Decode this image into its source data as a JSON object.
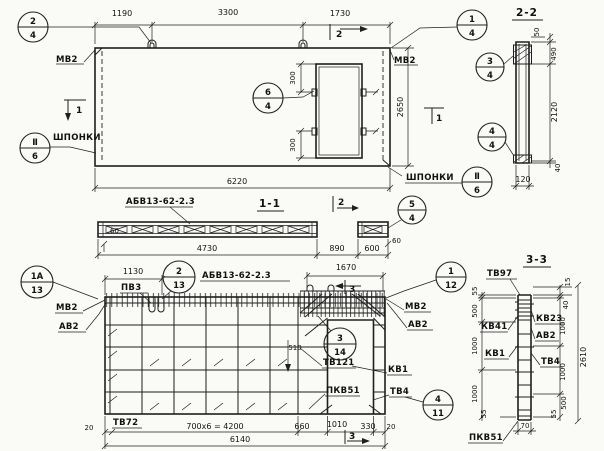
{
  "plan": {
    "dims": {
      "left": "1190",
      "mid": "3300",
      "right": "1730",
      "total": "6220",
      "height": "2650",
      "off_top": "300",
      "off_bot": "300"
    },
    "labels": {
      "mv2_left": "МВ2",
      "mv2_right": "МВ2",
      "shponki_left": "ШПОНКИ",
      "shponki_right": "ШПОНКИ"
    },
    "marks": {
      "s2": "2",
      "s1_left": "1",
      "s1_right": "1"
    }
  },
  "sec11": {
    "title": "1-1",
    "label": "АБВ13-62-2.3",
    "dims": {
      "d60l": "60",
      "d4730": "4730",
      "d890": "890",
      "d600": "600",
      "d60r": "60"
    },
    "mark2": "2"
  },
  "sec22": {
    "title": "2-2",
    "dims": {
      "d50": "50",
      "d490": "490",
      "d2120": "2120",
      "d40": "40",
      "d120": "120"
    }
  },
  "elev": {
    "title": "АБВ13-62-2.3",
    "labels": {
      "pv3": "ПВ3",
      "mv2_left": "МВ2",
      "av2_left": "АВ2",
      "mv2_right": "МВ2",
      "av2_right": "АВ2",
      "tv121": "ТВ121",
      "kv1": "КВ1",
      "pkv51": "ПКВ51",
      "tv4": "ТВ4",
      "tv72": "ТВ72"
    },
    "dims": {
      "d1130": "1130",
      "d1670": "1670",
      "d510": "510",
      "d20l": "20",
      "d4200": "700x6 = 4200",
      "d660": "660",
      "d1010": "1010",
      "d330": "330",
      "d20r": "20",
      "total": "6140"
    },
    "marks": {
      "s3_top": "3",
      "s3_bot": "3"
    }
  },
  "sec33": {
    "title": "3-3",
    "labels": {
      "tv97": "ТВ97",
      "kv41": "КВ41",
      "kv1": "КВ1",
      "kv23": "КВ23",
      "av2": "АВ2",
      "tv4": "ТВ4",
      "pkv51": "ПКВ51"
    },
    "dims_left": {
      "a": "55",
      "b": "500",
      "c": "1000",
      "d": "1000",
      "e": "55"
    },
    "dims_right": {
      "a": "15",
      "b": "40",
      "c": "1000",
      "d": "1000",
      "e": "500",
      "f": "55"
    },
    "dims": {
      "total": "2610",
      "d70": "70"
    }
  },
  "callouts": {
    "c2_4": {
      "num": "2",
      "den": "4"
    },
    "c1_4": {
      "num": "1",
      "den": "4"
    },
    "c3_4": {
      "num": "3",
      "den": "4"
    },
    "c4_4": {
      "num": "4",
      "den": "4"
    },
    "c6_4": {
      "num": "6",
      "den": "4"
    },
    "c5_4": {
      "num": "5",
      "den": "4"
    },
    "cII6_left": {
      "num": "Ⅱ",
      "den": "6"
    },
    "cII6_right": {
      "num": "Ⅱ",
      "den": "6"
    },
    "c1A_13": {
      "num": "1А",
      "den": "13"
    },
    "c2_13": {
      "num": "2",
      "den": "13"
    },
    "c1_12": {
      "num": "1",
      "den": "12"
    },
    "c3_14": {
      "num": "3",
      "den": "14"
    },
    "c4_11": {
      "num": "4",
      "den": "11"
    }
  }
}
